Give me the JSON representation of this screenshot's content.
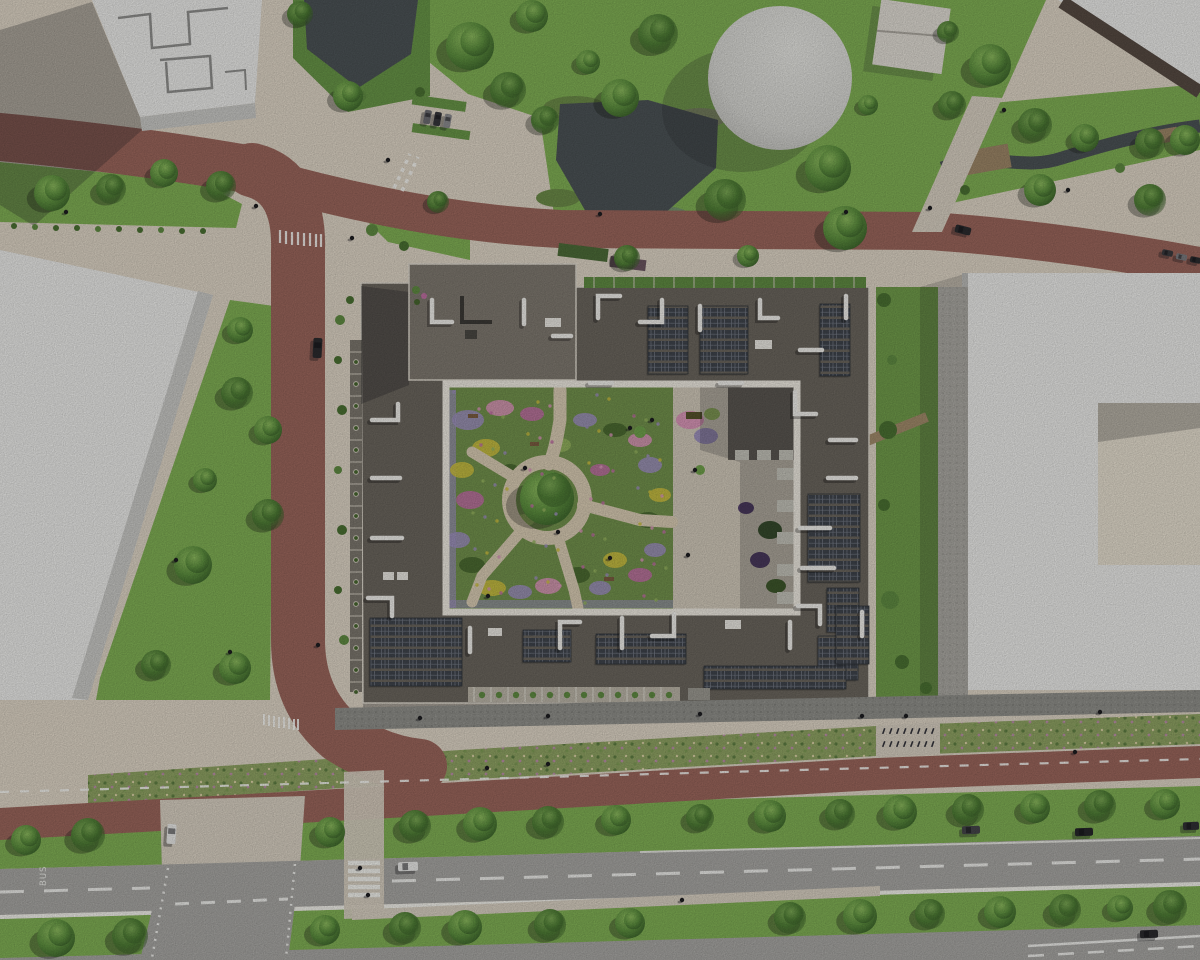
{
  "meta": {
    "title": "Aerial architectural site render",
    "view": "top-down bird's-eye rendering",
    "subject": "Courtyard apartment block with rooftop solar panels and roof garden, surrounded by streets, lawns, ponds and neighbouring buildings"
  },
  "markings": {
    "bus_lane": "BUS"
  },
  "palette": {
    "plaza": "#dcd3c4",
    "sidewalk": "#d6cec0",
    "road_red": "#99655b",
    "road_gray": "#a6a5a2",
    "grass": "#7fae54",
    "grass_dark": "#679447",
    "meadow": "#8da162",
    "tree": "#5d8f3f",
    "tree_dark": "#3f6b2f",
    "water": "#4b5255",
    "roof": "#6a655d",
    "roof_tower": "#7e786f",
    "solar": "#3f444c",
    "solar_grid": "#737984",
    "white_bldg": "#e9e9e7",
    "white_bldg_shade": "#c7c7c4",
    "parapet": "#ece8df",
    "courtyard_path": "#d7cab2",
    "garden_green": "#71904c",
    "terrace": "#cfc7b8",
    "east_strip": "#6f9a4a",
    "balcony_strip": "#7b766d",
    "flower_lavender": "#9b8fba",
    "flower_yellow": "#c9bd3f",
    "flower_magenta": "#bd6fa1",
    "flower_pink": "#d795b6",
    "promenade": "#8e8e89",
    "marking_white": "#f2f2ee",
    "deck": "#9b8566",
    "car_dark": "#2b2b2e",
    "car_white": "#e8e8e6",
    "shadow": "rgba(35,35,40,0.28)"
  },
  "scene": {
    "elements": [
      "central-courtyard-building",
      "rooftop-solar-arrays",
      "roof-vents",
      "courtyard-garden",
      "courtyard-terrace",
      "white-office-buildings",
      "circular-tank-building",
      "pavilion",
      "ponds",
      "creek-with-decks",
      "red-asphalt-streets",
      "cycle-street",
      "gray-road",
      "bus-lane-marking",
      "pedestrian-crossings",
      "street-trees",
      "lawns",
      "wildflower-verges",
      "cars",
      "cyclists",
      "pedestrians",
      "bike-parking"
    ]
  }
}
